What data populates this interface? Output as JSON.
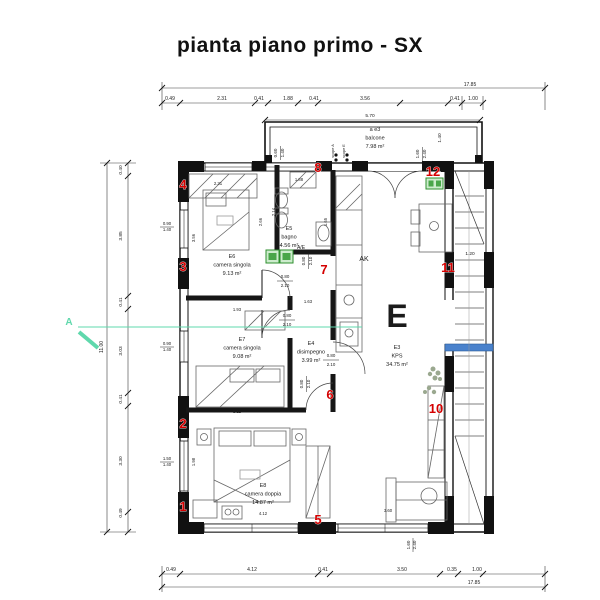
{
  "title": "pianta piano primo - SX",
  "colors": {
    "marker_red": "#d40000",
    "unit_green": "#2e8f2e",
    "section_teal": "#5fd8ac",
    "railing_blue": "#4a82cc",
    "wall_black": "#111111"
  },
  "rooms": [
    {
      "id": "a  e3",
      "name": "balcone",
      "area": "7.98 m²",
      "x": 375,
      "y": 131
    },
    {
      "id": "E5",
      "name": "bagno",
      "area": "4.56 m²",
      "x": 289,
      "y": 230
    },
    {
      "id": "E6",
      "name": "camera singola",
      "area": "9.13 m²",
      "x": 232,
      "y": 258
    },
    {
      "id": "E7",
      "name": "camera singola",
      "area": "9.08 m²",
      "x": 242,
      "y": 341
    },
    {
      "id": "E4",
      "name": "disimpegno",
      "area": "3.99 m²",
      "x": 311,
      "y": 345
    },
    {
      "id": "E8",
      "name": "camera doppia",
      "area": "14.87 m²",
      "x": 263,
      "y": 487
    },
    {
      "id": "E3",
      "name": "KPS",
      "area": "34.75 m²",
      "x": 397,
      "y": 349,
      "big": "E"
    }
  ],
  "markers": [
    {
      "n": "1",
      "x": 183,
      "y": 511
    },
    {
      "n": "2",
      "x": 183,
      "y": 428
    },
    {
      "n": "3",
      "x": 183,
      "y": 271
    },
    {
      "n": "4",
      "x": 183,
      "y": 189
    },
    {
      "n": "5",
      "x": 318,
      "y": 524
    },
    {
      "n": "6",
      "x": 330,
      "y": 399
    },
    {
      "n": "7",
      "x": 324,
      "y": 274
    },
    {
      "n": "8",
      "x": 318,
      "y": 172
    },
    {
      "n": "10",
      "x": 436,
      "y": 413
    },
    {
      "n": "11",
      "x": 448,
      "y": 272
    },
    {
      "n": "12",
      "x": 433,
      "y": 176
    }
  ],
  "section": {
    "label": "A"
  },
  "dims": [
    {
      "t": "17.85",
      "x": 470,
      "y": 86
    },
    {
      "t": "0.49",
      "x": 170,
      "y": 100
    },
    {
      "t": "2.31",
      "x": 222,
      "y": 100
    },
    {
      "t": "0.41",
      "x": 259,
      "y": 100
    },
    {
      "t": "1.88",
      "x": 288,
      "y": 100
    },
    {
      "t": "0.41",
      "x": 314,
      "y": 100
    },
    {
      "t": "3.56",
      "x": 365,
      "y": 100
    },
    {
      "t": "0.41",
      "x": 455,
      "y": 100
    },
    {
      "t": "1.00",
      "x": 473,
      "y": 100
    },
    {
      "t": "5.70",
      "x": 370,
      "y": 117,
      "s": 4.8
    },
    {
      "t": "1.40",
      "x": 441,
      "y": 138,
      "r": -90,
      "s": 4.8
    },
    {
      "t": "0.60",
      "x": 277,
      "y": 153,
      "r": -90,
      "s": 4.5
    },
    {
      "t": "1.40",
      "x": 284,
      "y": 153,
      "r": -90,
      "s": 4.5
    },
    {
      "t": "1.60",
      "x": 419,
      "y": 154,
      "r": -90,
      "s": 4.5
    },
    {
      "t": "2.40",
      "x": 426,
      "y": 154,
      "r": -90,
      "s": 4.5
    },
    {
      "t": "scope A",
      "x": 334,
      "y": 151,
      "r": -90,
      "s": 3.8,
      "n": "scope-a-label"
    },
    {
      "t": "scope E",
      "x": 345,
      "y": 151,
      "r": -90,
      "s": 3.8,
      "n": "scope-e-label"
    },
    {
      "t": "11.00",
      "x": 103,
      "y": 347,
      "r": -90
    },
    {
      "t": "0.40",
      "x": 122,
      "y": 170,
      "r": -90,
      "s": 4.8
    },
    {
      "t": "3.85",
      "x": 122,
      "y": 236,
      "r": -90,
      "s": 4.8
    },
    {
      "t": "0.41",
      "x": 122,
      "y": 302,
      "r": -90,
      "s": 4.8
    },
    {
      "t": "3.03",
      "x": 122,
      "y": 351,
      "r": -90,
      "s": 4.8
    },
    {
      "t": "0.41",
      "x": 122,
      "y": 399,
      "r": -90,
      "s": 4.8
    },
    {
      "t": "3.30",
      "x": 122,
      "y": 461,
      "r": -90,
      "s": 4.8
    },
    {
      "t": "0.49",
      "x": 122,
      "y": 513,
      "r": -90,
      "s": 4.8
    },
    {
      "t": "0.90",
      "x": 167,
      "y": 225,
      "s": 4.3
    },
    {
      "t": "1.40",
      "x": 167,
      "y": 231,
      "s": 4.3
    },
    {
      "t": "0.90",
      "x": 167,
      "y": 345,
      "s": 4.3
    },
    {
      "t": "1.40",
      "x": 167,
      "y": 351,
      "s": 4.3
    },
    {
      "t": "1.50",
      "x": 167,
      "y": 460,
      "s": 4.3
    },
    {
      "t": "1.40",
      "x": 167,
      "y": 466,
      "s": 4.3
    },
    {
      "t": "0.49",
      "x": 171,
      "y": 571
    },
    {
      "t": "4.12",
      "x": 252,
      "y": 571
    },
    {
      "t": "0.41",
      "x": 323,
      "y": 571
    },
    {
      "t": "3.50",
      "x": 402,
      "y": 571
    },
    {
      "t": "0.35",
      "x": 452,
      "y": 571
    },
    {
      "t": "1.00",
      "x": 477,
      "y": 571
    },
    {
      "t": "17.85",
      "x": 474,
      "y": 584
    },
    {
      "t": "1.60",
      "x": 410,
      "y": 545,
      "r": -90,
      "s": 4.5
    },
    {
      "t": "2.40",
      "x": 416,
      "y": 545,
      "r": -90,
      "s": 4.5
    },
    {
      "t": "2.31",
      "x": 218,
      "y": 185,
      "s": 4.3
    },
    {
      "t": "1.88",
      "x": 299,
      "y": 181,
      "s": 4.2
    },
    {
      "t": "3.56",
      "x": 195,
      "y": 238,
      "r": -90,
      "s": 4.2
    },
    {
      "t": "2.14",
      "x": 275,
      "y": 212,
      "r": -90,
      "s": 4.2
    },
    {
      "t": "2.66",
      "x": 262,
      "y": 222,
      "r": -90,
      "s": 4.2
    },
    {
      "t": "1.65",
      "x": 327,
      "y": 222,
      "r": -90,
      "s": 4.2
    },
    {
      "t": "1.93",
      "x": 237,
      "y": 311,
      "s": 4.2
    },
    {
      "t": "1.63",
      "x": 308,
      "y": 303,
      "s": 4.2
    },
    {
      "t": "5.11",
      "x": 237,
      "y": 413,
      "s": 4.3
    },
    {
      "t": "4.12",
      "x": 263,
      "y": 515,
      "s": 4.2
    },
    {
      "t": "1.98",
      "x": 195,
      "y": 462,
      "r": -90,
      "s": 4.2
    },
    {
      "t": "3.60",
      "x": 388,
      "y": 512,
      "s": 4.3
    },
    {
      "t": "1.20",
      "x": 470,
      "y": 255,
      "s": 4.8
    },
    {
      "t": "AK",
      "x": 364,
      "y": 261,
      "s": 7,
      "n": "kitchen-label"
    },
    {
      "t": "A/E",
      "x": 301,
      "y": 249,
      "s": 5,
      "n": "ae-unit-label"
    },
    {
      "t": "0.80",
      "x": 285,
      "y": 278,
      "s": 4.4
    },
    {
      "t": "2.10",
      "x": 285,
      "y": 287,
      "s": 4.4
    },
    {
      "t": "0.80",
      "x": 287,
      "y": 317,
      "s": 4.4
    },
    {
      "t": "2.10",
      "x": 287,
      "y": 326,
      "s": 4.4
    },
    {
      "t": "0.80",
      "x": 331,
      "y": 357,
      "s": 4.4
    },
    {
      "t": "2.10",
      "x": 331,
      "y": 366,
      "s": 4.4
    },
    {
      "t": "0.80",
      "x": 303,
      "y": 384,
      "r": -90,
      "s": 4.4
    },
    {
      "t": "2.10",
      "x": 310,
      "y": 384,
      "r": -90,
      "s": 4.4
    },
    {
      "t": "0.80",
      "x": 305,
      "y": 261,
      "r": -90,
      "s": 4.4
    },
    {
      "t": "2.10",
      "x": 312,
      "y": 261,
      "r": -90,
      "s": 4.4
    }
  ]
}
